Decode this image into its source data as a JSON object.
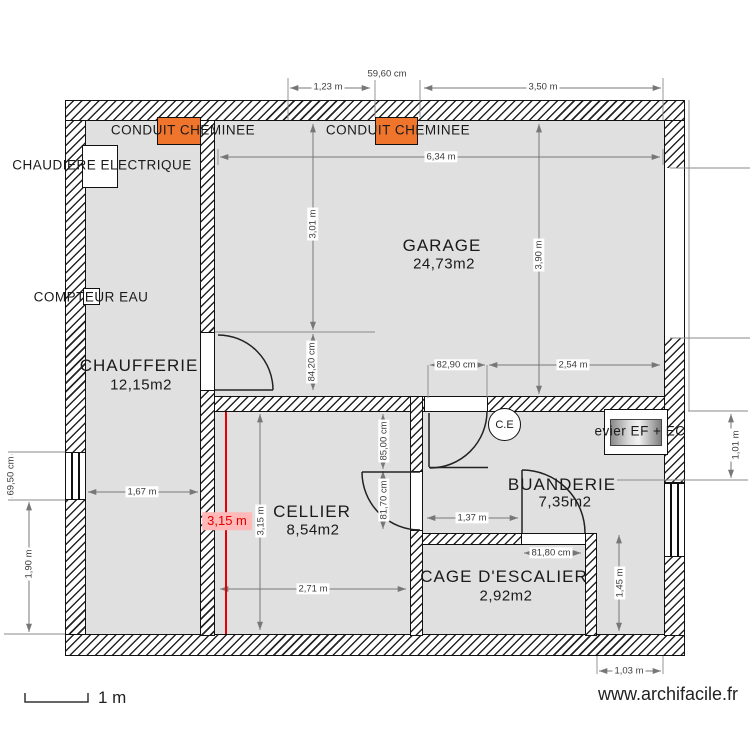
{
  "plan": {
    "rooms": [
      {
        "name": "CHAUFFERIE",
        "area": "12,15m2"
      },
      {
        "name": "GARAGE",
        "area": "24,73m2"
      },
      {
        "name": "CELLIER",
        "area": "8,54m2"
      },
      {
        "name": "BUANDERIE",
        "area": "7,35m2"
      },
      {
        "name": "CAGE D'ESCALIER",
        "area": "2,92m2"
      }
    ],
    "annotations": {
      "conduit1": "CONDUIT CHEMINEE",
      "conduit2": "CONDUIT CHEMINEE",
      "chaudiere": "CHAUDIERE ELECTRIQUE",
      "compteur": "COMPTEUR EAU",
      "evier": "evier EF + EC",
      "ce": "C.E"
    },
    "dimensions": {
      "top_left": "1,23 m",
      "top_mid": "59,60 cm",
      "top_right": "3,50 m",
      "garage_width": "6,34 m",
      "garage_height_upper": "3,01 m",
      "garage_height_full": "3,90 m",
      "chauf_door": "84,20 cm",
      "buand_opening": "82,90 cm",
      "garage_bottom_right": "2,54 m",
      "chauf_width": "1,67 m",
      "left_window": "69,50 cm",
      "left_lower": "1,90 m",
      "cellier_height_red": "3,15 m",
      "cellier_height": "3,15 m",
      "cellier_width": "2,71 m",
      "cellier_right_upper": "85,00 cm",
      "cellier_right_lower": "81,70 cm",
      "buanderie_width": "1,37 m",
      "cage_door": "81,80 cm",
      "cage_right_height": "1,45 m",
      "bottom_right_width": "1,03 m",
      "right_side_height": "1,01 m"
    },
    "footer": {
      "scale_label": "1 m",
      "watermark": "www.archifacile.fr"
    },
    "colors": {
      "accent_orange": "#f0752c",
      "room_fill": "#e0e0e0",
      "measure_red": "#e60000"
    }
  }
}
